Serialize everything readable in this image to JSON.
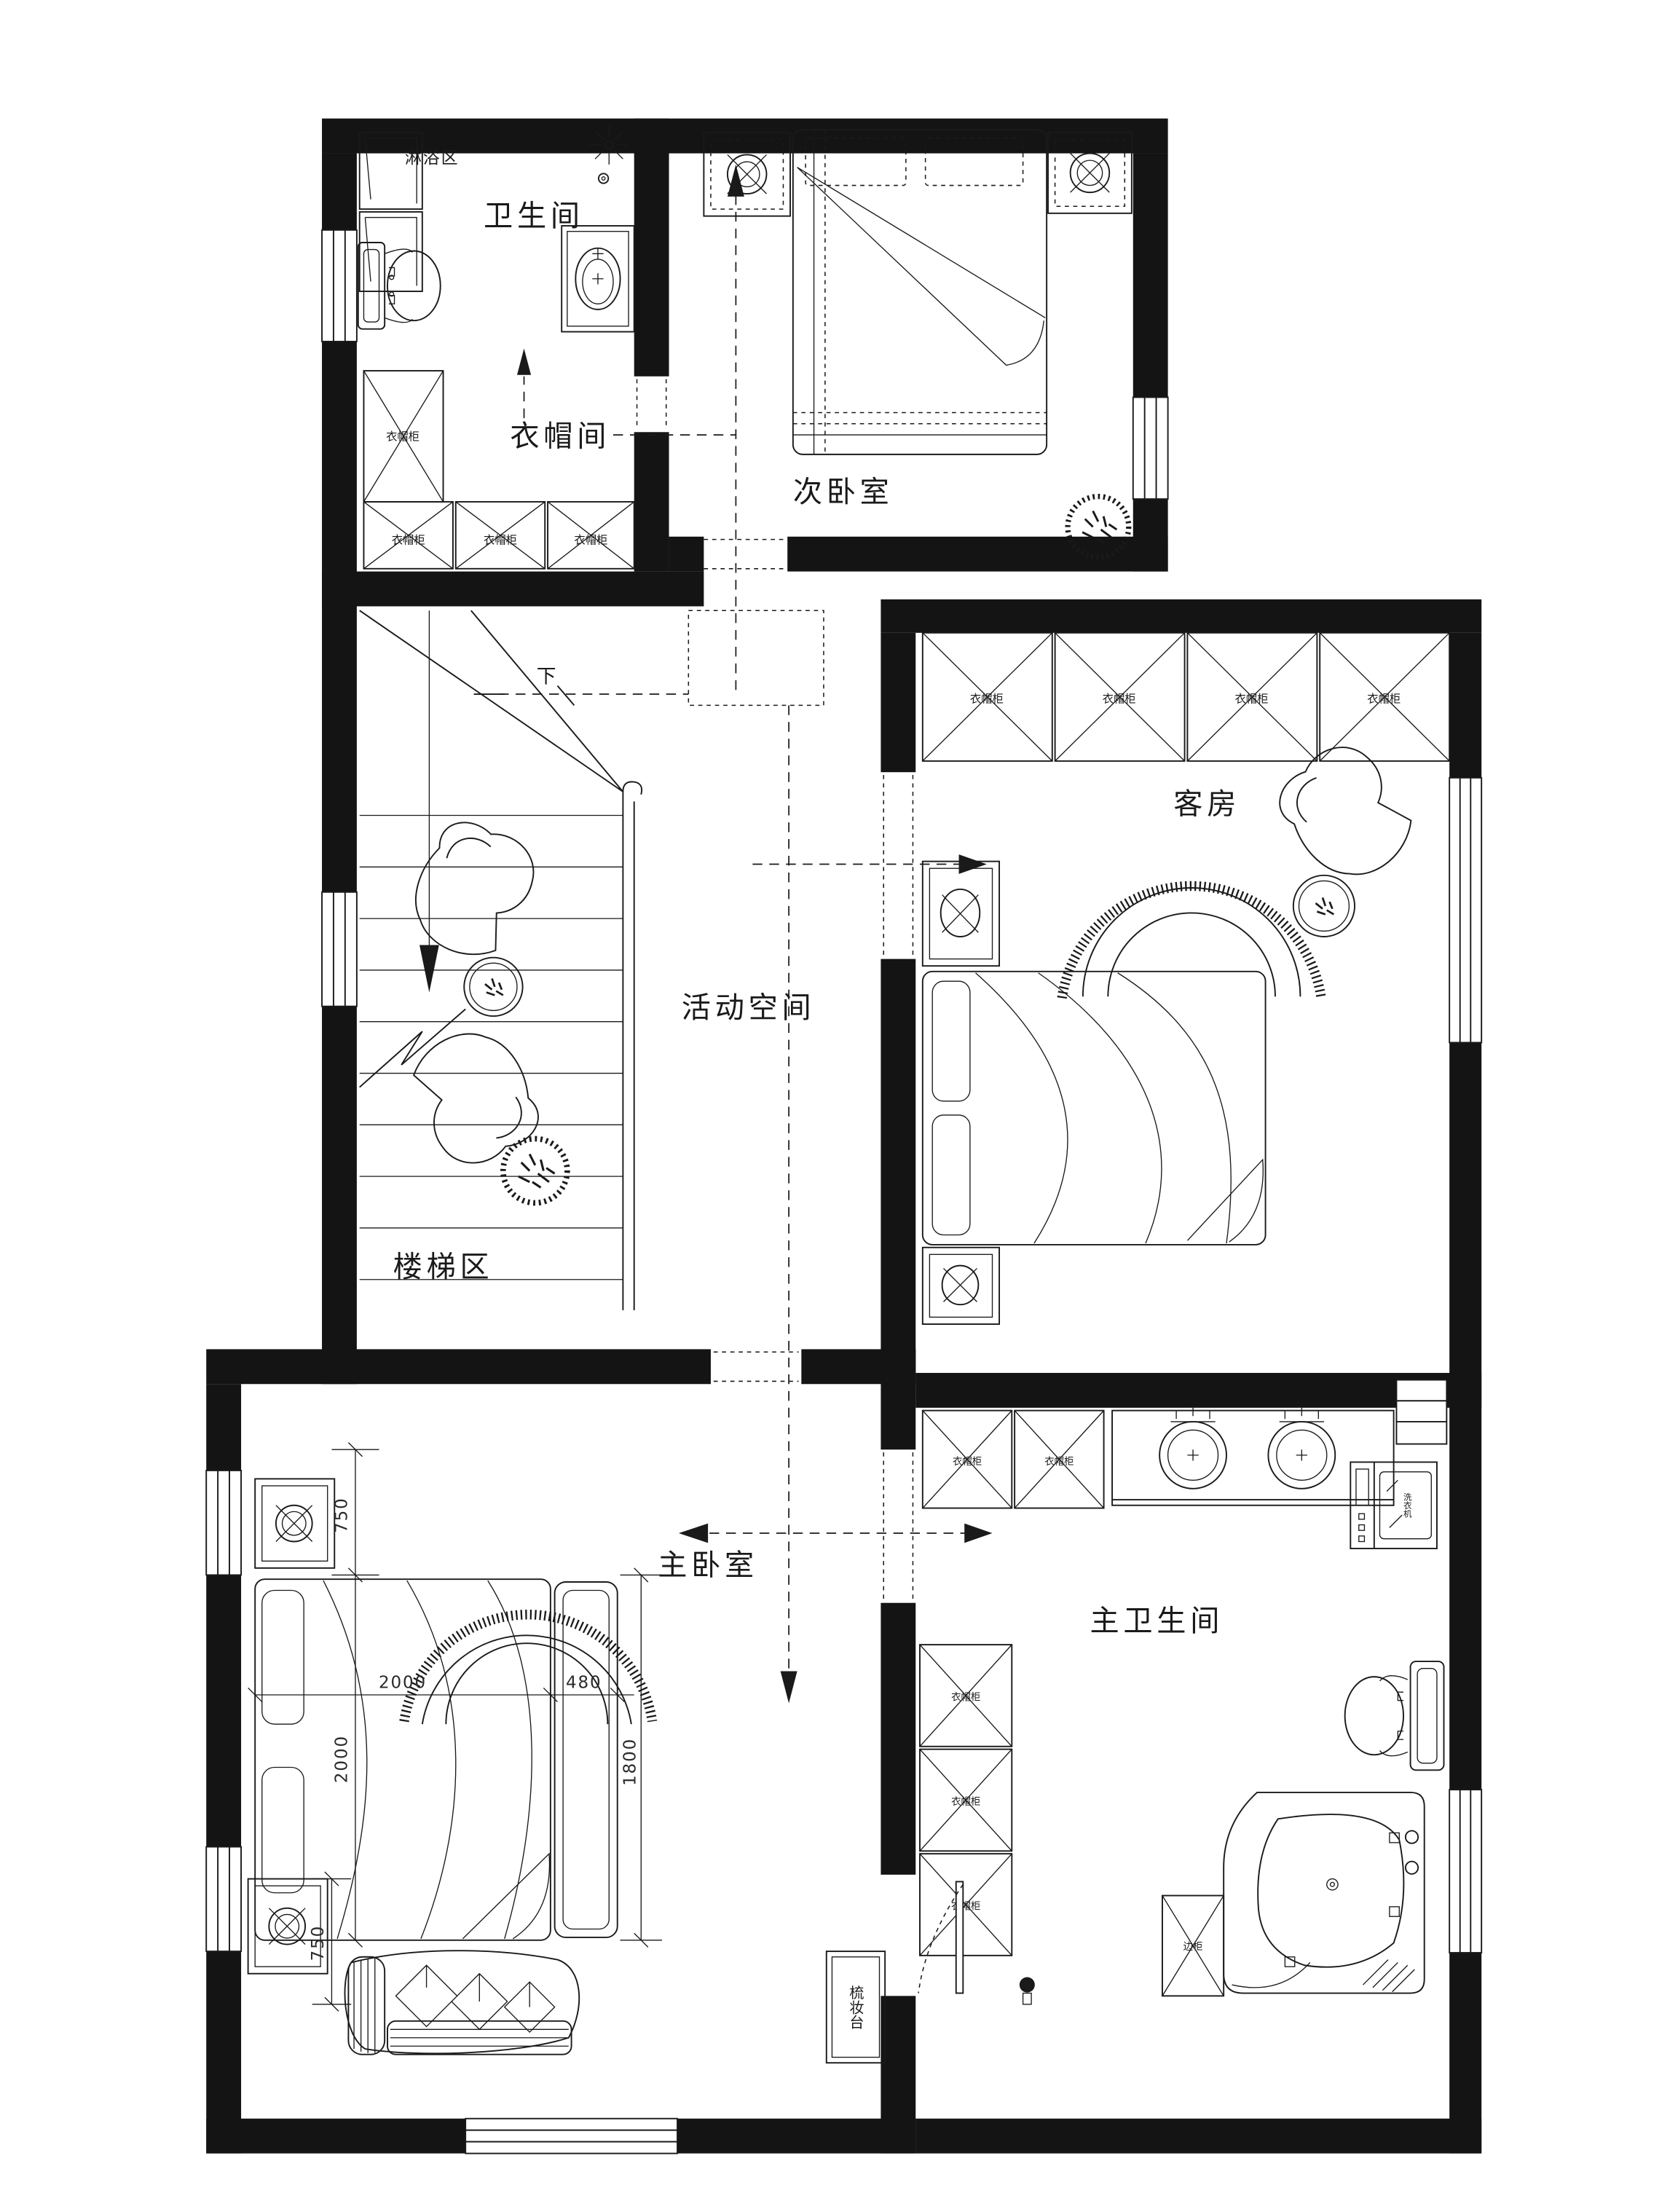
{
  "rooms": {
    "shower_zone": "淋浴区",
    "bathroom": "卫生间",
    "cloakroom": "衣帽间",
    "secondary_bedroom": "次卧室",
    "guest_room": "客房",
    "activity_space": "活动空间",
    "stair_area": "楼梯区",
    "master_bedroom": "主卧室",
    "master_bathroom": "主卫生间"
  },
  "labels": {
    "wardrobe_cabinet": "衣帽柜",
    "side_cabinet": "边柜",
    "dresser": "梳妆台",
    "washing_machine": "洗衣机",
    "stairs_down": "下"
  },
  "dimensions": {
    "bed_length_mm": "2000",
    "bed_width_mm": "2000",
    "bedside_cabinet_mm": "480",
    "bed_inner_mm": "1800",
    "nightstand_top_mm": "750",
    "nightstand_bottom_mm": "750"
  },
  "colors": {
    "wall": "#141414",
    "line": "#1a1a1a",
    "background": "#ffffff"
  }
}
